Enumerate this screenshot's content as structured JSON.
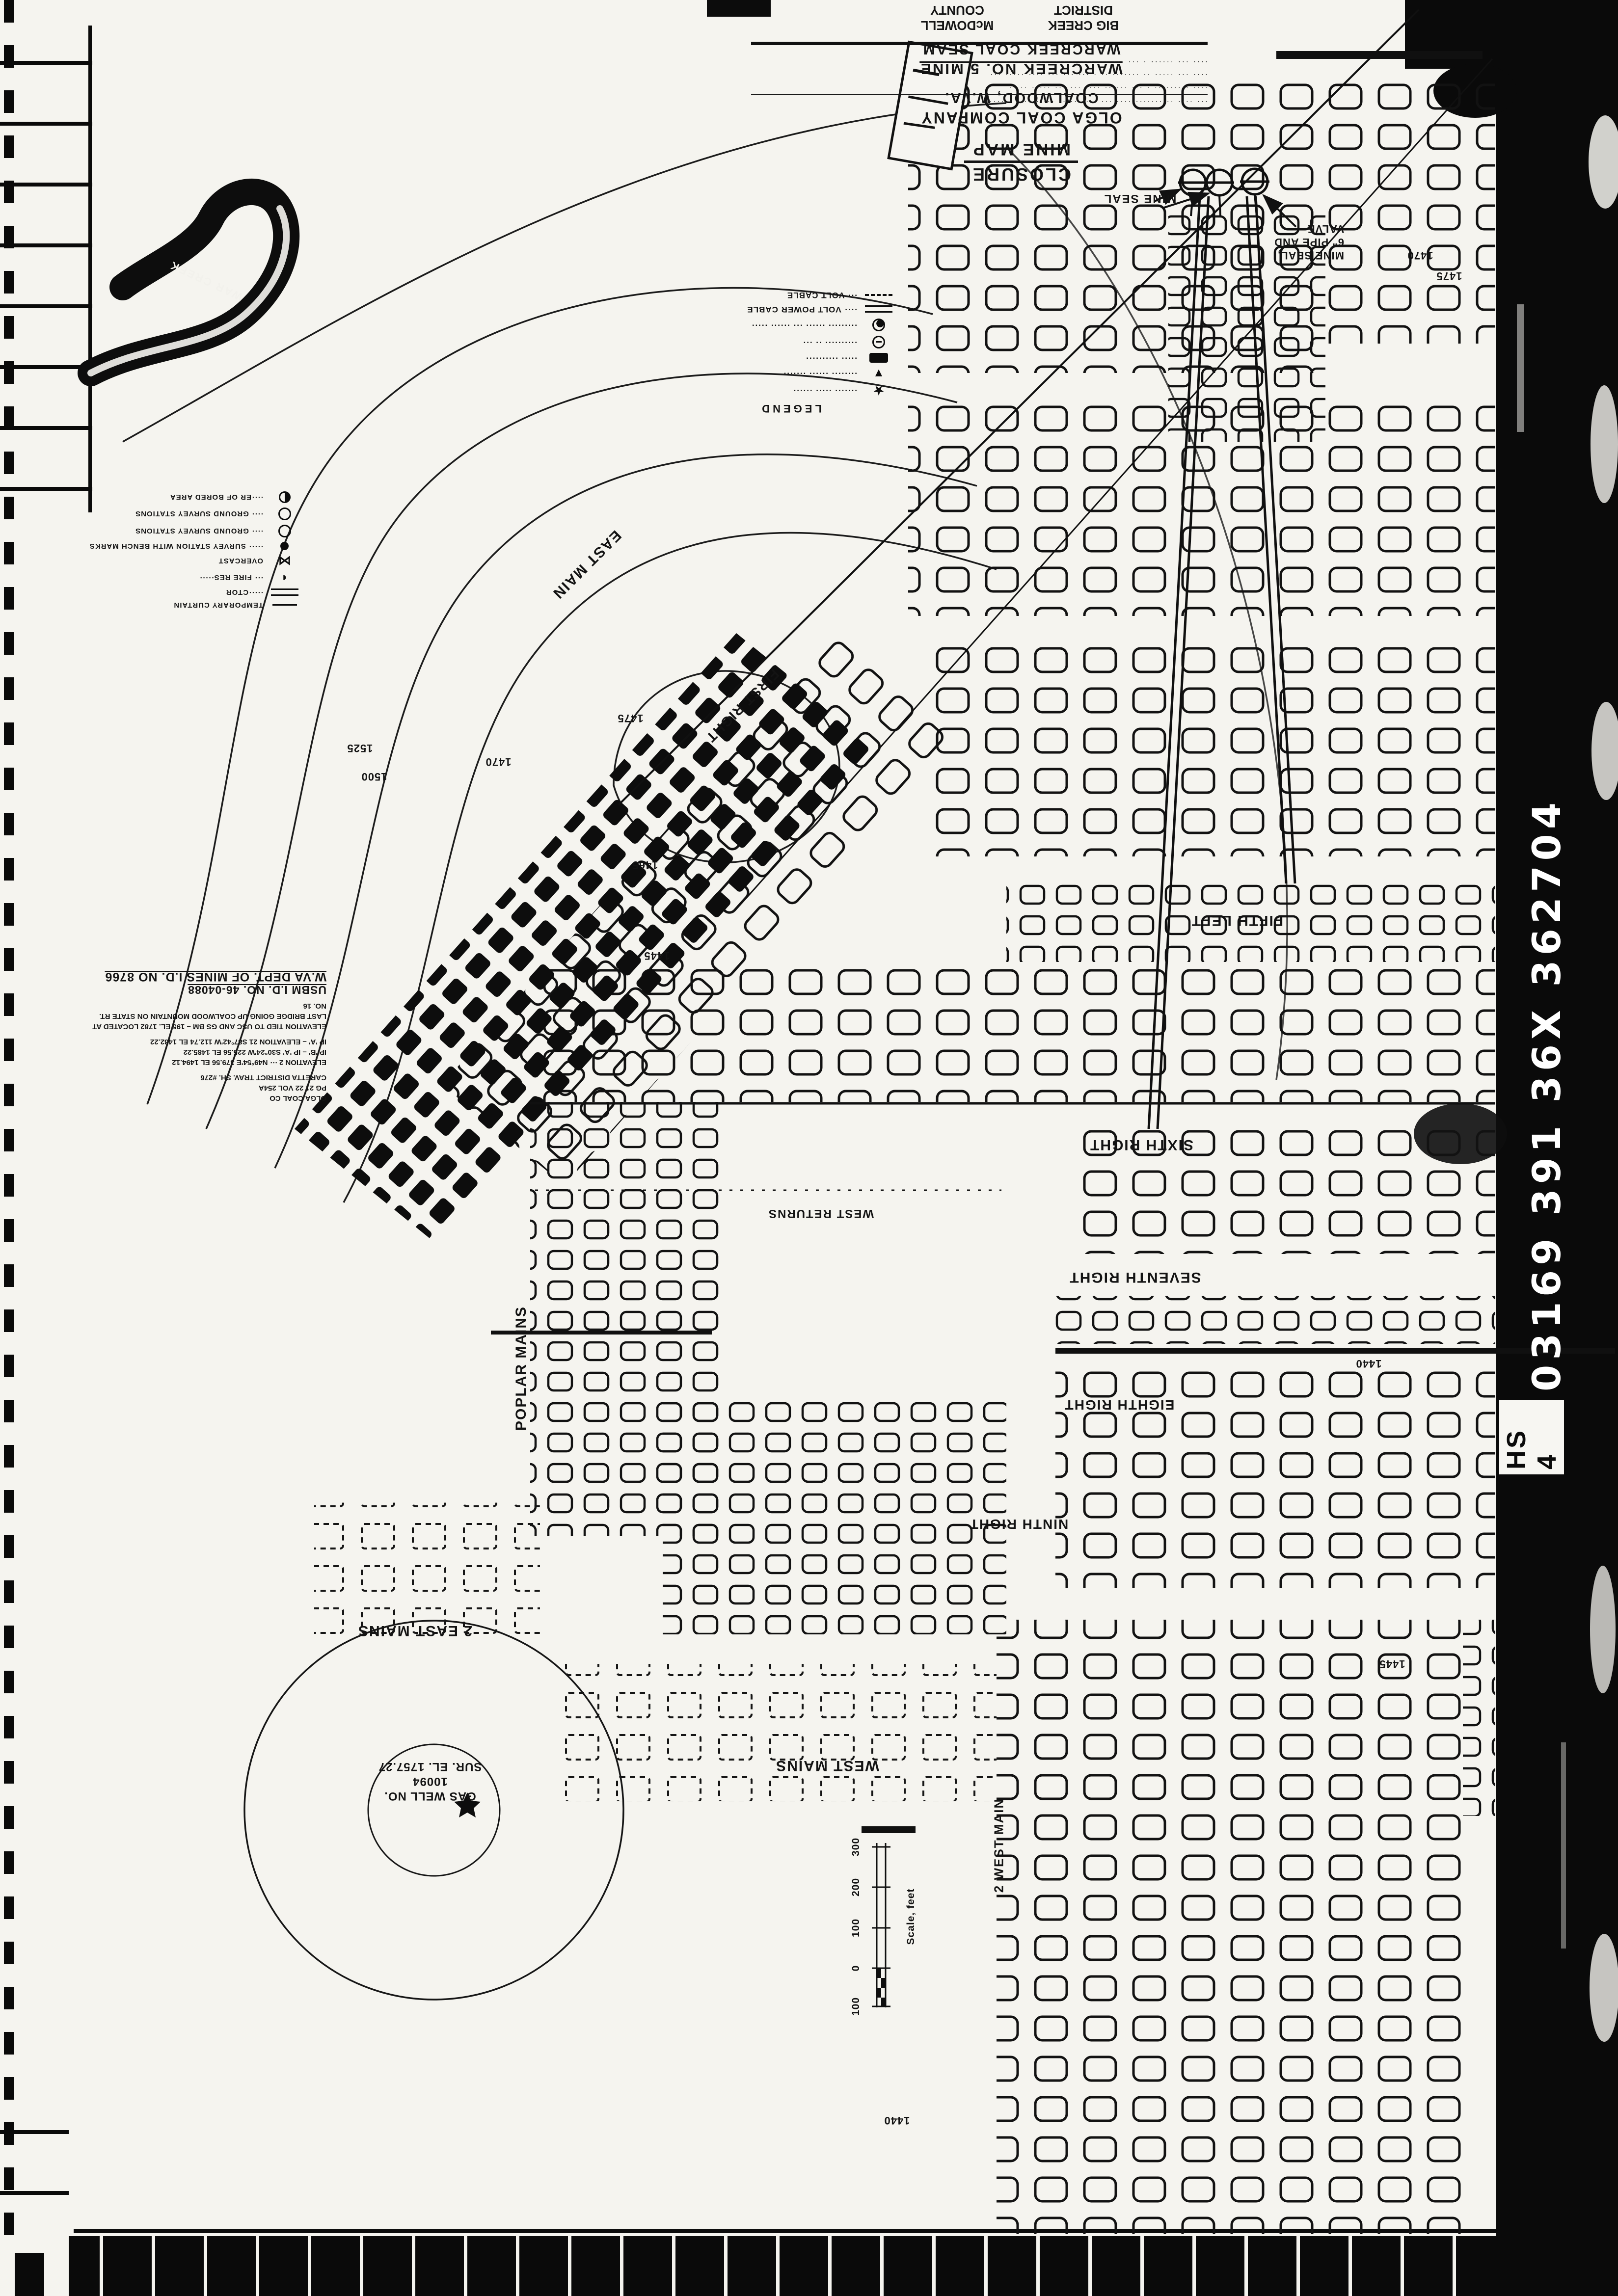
{
  "film": {
    "id_number": "03169 391 36X 362704",
    "reel_label": "HS 4"
  },
  "title_block": {
    "heading1": "CLOSURE",
    "heading2": "MINE MAP",
    "company": "OLGA COAL COMPANY",
    "location": "COALWOOD, W.VA.",
    "mine": "WARCREEK NO. 5 MINE",
    "seam": "WARCREEK COAL SEAM",
    "district": "BIG CREEK DISTRICT",
    "county": "McDOWELL COUNTY",
    "near": "EAST OF CARETTA, W.VA.",
    "scale": "SCALE 1\" = 100'"
  },
  "certification": {
    "lines": [
      "··· ···· ·· ······· ···· ··· ······· ·· ··· ······ ·······",
      "···· ········· · ··· ······ ···· ··· ··· ····· ·· ··",
      "···· ··· ····· ·· ······· ·· · ··· ··· ··· ···· ····· ···",
      "···· ··· ······ · ··· ··· ··· ···· ····· ······· ·· ·"
    ]
  },
  "ids_block": {
    "lines": [
      "OLGA COAL CO",
      "PG 21 22 VOL 254A",
      "CARETTA DISTRICT TRAV. SH. #276",
      "ELEVATION 2 ··· N49°54'E  379.56  EL 1494.12",
      "IP 'B' – IP 'A'  S30°24'W  225.56  EL 1485.22",
      "IP 'A' – ELEVATION 21  S87°42'W  112.74  EL 1482.22",
      "ELEVATION TIED TO USC AND GS BM – 195 EL. 1782 LOCATED AT",
      "LAST BRIDGE GOING UP COALWOOD MOUNTAIN ON STATE RT. NO. 16"
    ],
    "usbm": "USBM I.D. NO. 46-04088",
    "wv_dept": "W.VA DEPT. OF MINES I.D. NO 8766"
  },
  "legend": {
    "heading": "LEGEND",
    "a_entries": [
      {
        "symbol": "star",
        "label": "······· ····· ······"
      },
      {
        "symbol": "triangle-down",
        "label": "········ ······ ·······"
      },
      {
        "symbol": "filled-rect",
        "label": "····· ··········"
      },
      {
        "symbol": "circle-dial",
        "label": "·········· ·· ···"
      },
      {
        "symbol": "circle-vane",
        "label": "········· ······ ··· ······ ·····"
      },
      {
        "symbol": "double-line",
        "label": "···· VOLT POWER CABLE"
      },
      {
        "symbol": "dashed-line",
        "label": "··· VOLT CABLE"
      }
    ],
    "b_entries": [
      {
        "symbol": "curtain-line",
        "label": "TEMPORARY CURTAIN"
      },
      {
        "symbol": "double-line",
        "label": "·····CTOR"
      },
      {
        "symbol": "half-circle",
        "label": "··· FIRE RES·····"
      },
      {
        "symbol": "overcast",
        "label": "OVERCAST"
      },
      {
        "symbol": "filled-circle",
        "label": "····· SURVEY STATION WITH BENCH MARKS"
      },
      {
        "symbol": "open-circle",
        "label": "···· GROUND SURVEY STATIONS"
      },
      {
        "symbol": "open-circle",
        "label": "···· GROUND SURVEY STATIONS"
      },
      {
        "symbol": "half-filled-circle",
        "label": "····ER OF BORED AREA"
      }
    ]
  },
  "streets": {
    "east_main": "EAST MAIN",
    "first_right": "FIRST RIGHT",
    "fifth_left": "FIFTH LEFT",
    "sixth_right": "SIXTH RIGHT",
    "seventh_right": "SEVENTH RIGHT",
    "eighth_right": "EIGHTH RIGHT",
    "ninth_right": "NINTH RIGHT",
    "poplar_mains": "POPLAR MAINS",
    "west_returns": "WEST RETURNS",
    "west_mains": "WEST MAINS",
    "two_east_mains": "2 EAST MAINS",
    "two_west_main": "2 WEST MAIN"
  },
  "contours": [
    "1475",
    "1470",
    "1465",
    "1445",
    "1525",
    "1500",
    "1470",
    "1475",
    "1440",
    "1445",
    "1440"
  ],
  "gas_well": {
    "name": "GAS WELL NO. 10094",
    "elevation": "SUR. EL. 1757.27"
  },
  "seals": {
    "label": "MINE SEAL",
    "note_line1": "MINE SEAL,",
    "note_line2": "6\" PIPE AND",
    "note_line3": "VALVE"
  },
  "scale_bar": {
    "ticks": [
      "300",
      "200",
      "100",
      "0",
      "100"
    ],
    "caption": "Scale, feet"
  },
  "creek": {
    "name": "WAR CREEK"
  }
}
